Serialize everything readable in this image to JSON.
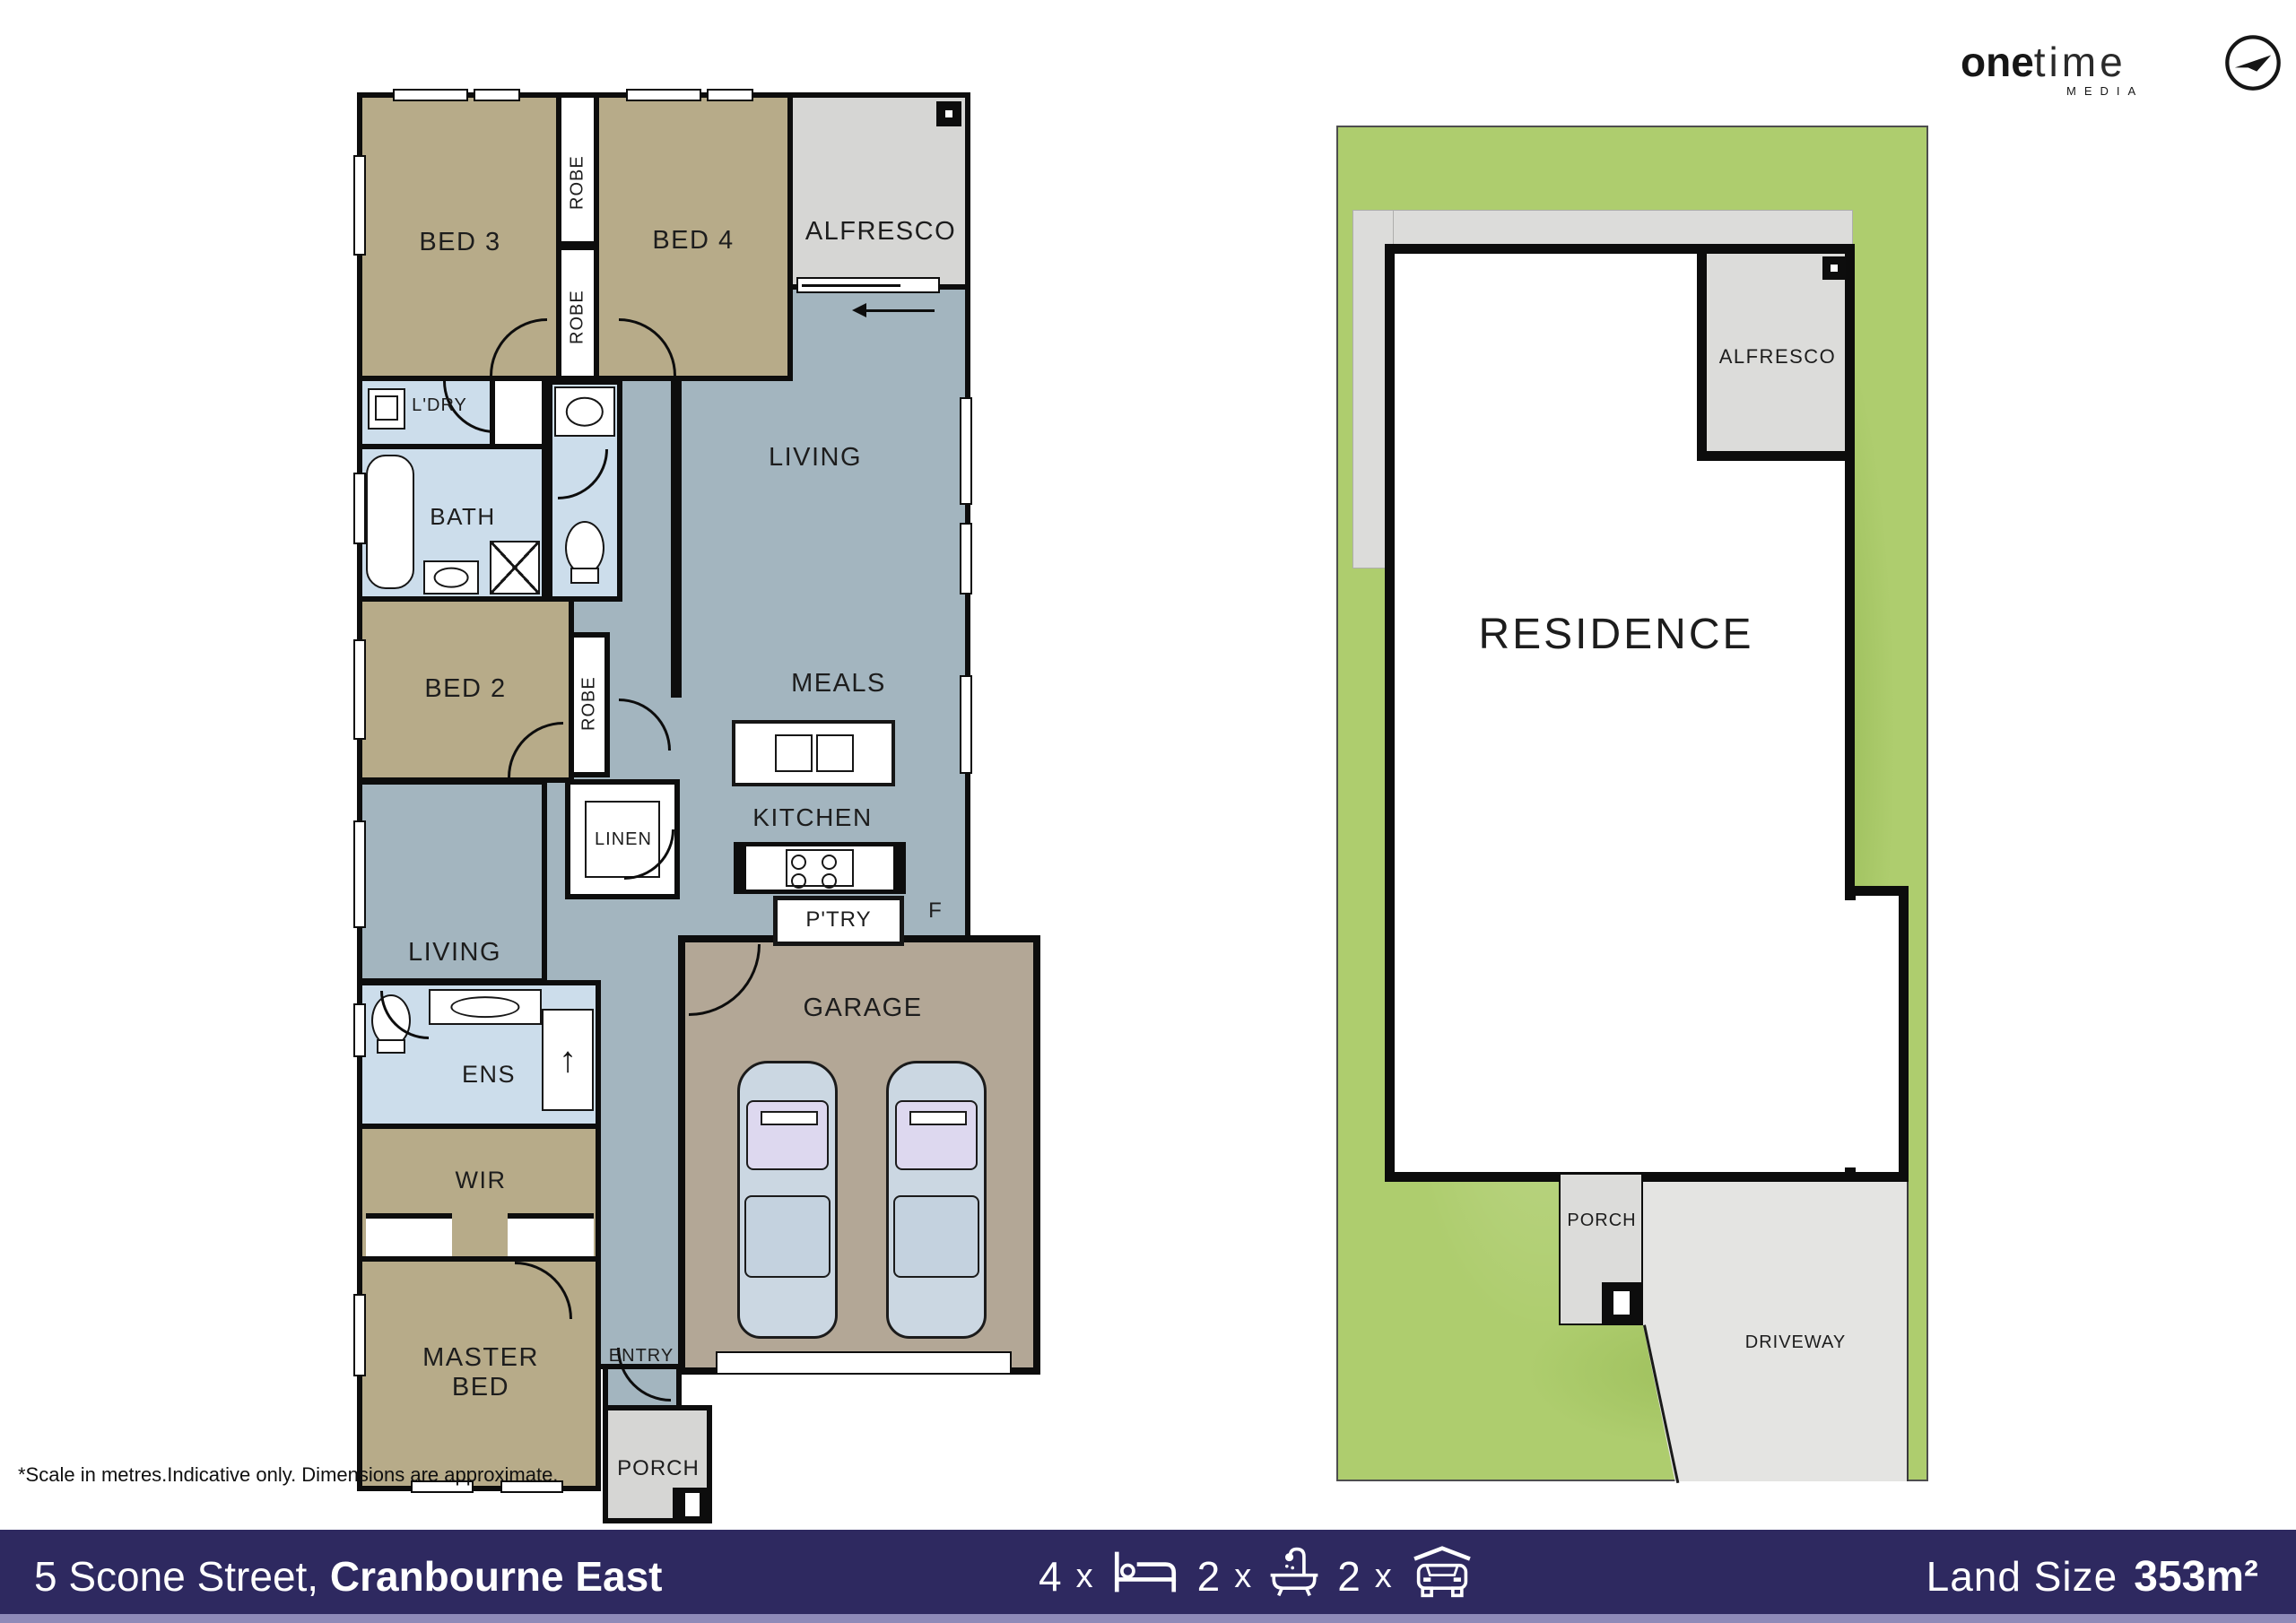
{
  "logo": {
    "word_bold": "one",
    "word_light": "time",
    "subtitle": "MEDIA"
  },
  "floorplan": {
    "bed3": "BED 3",
    "bed4": "BED 4",
    "bed2": "BED 2",
    "robe": "ROBE",
    "alfresco": "ALFRESCO",
    "ldry": "L'DRY",
    "bath": "BATH",
    "living": "LIVING",
    "meals": "MEALS",
    "kitchen": "KITCHEN",
    "linen": "LINEN",
    "ptry": "P'TRY",
    "fridge": "F",
    "ens": "ENS",
    "wir": "WIR",
    "master_bed": "MASTER BED",
    "entry": "ENTRY",
    "garage": "GARAGE",
    "porch": "PORCH"
  },
  "siteplan": {
    "residence": "RESIDENCE",
    "alfresco": "ALFRESCO",
    "porch": "PORCH",
    "driveway": "DRIVEWAY"
  },
  "disclaimer": "*Scale in metres.Indicative only. Dimensions are approximate.",
  "footer": {
    "street": "5 Scone Street, ",
    "suburb": "Cranbourne East",
    "beds_count": "4",
    "baths_count": "2",
    "cars_count": "2",
    "multiplier": "x",
    "land_size_label": "Land Size",
    "land_size_value": "353m²"
  },
  "colors": {
    "footer_bg": "#2e2960",
    "bedroom_fill": "#b7ab89",
    "living_fill": "#a3b5bf",
    "wet_area_fill": "#ccddeb",
    "garage_fill": "#b3a796",
    "outdoor_fill": "#d6d6d4",
    "site_grass": "#aecd6e",
    "driveway_fill": "#e4e4e2",
    "wall": "#0d0d0d"
  }
}
